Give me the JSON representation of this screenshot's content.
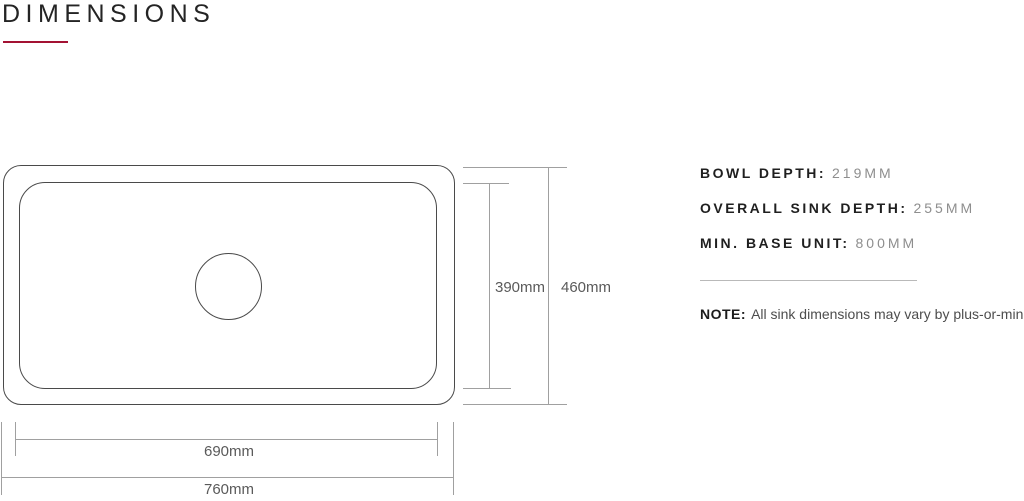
{
  "page": {
    "title": "DIMENSIONS",
    "accent_color": "#a31233"
  },
  "diagram": {
    "inner_width_label": "690mm",
    "outer_width_label": "760mm",
    "inner_height_label": "390mm",
    "outer_height_label": "460mm"
  },
  "specs": {
    "items": [
      {
        "label": "BOWL DEPTH:",
        "value": "219MM"
      },
      {
        "label": "OVERALL SINK DEPTH:",
        "value": "255MM"
      },
      {
        "label": "MIN. BASE UNIT:",
        "value": "800MM"
      }
    ],
    "note": {
      "label": "NOTE:",
      "text": "All sink dimensions may vary by plus-or-minus 2%"
    }
  }
}
